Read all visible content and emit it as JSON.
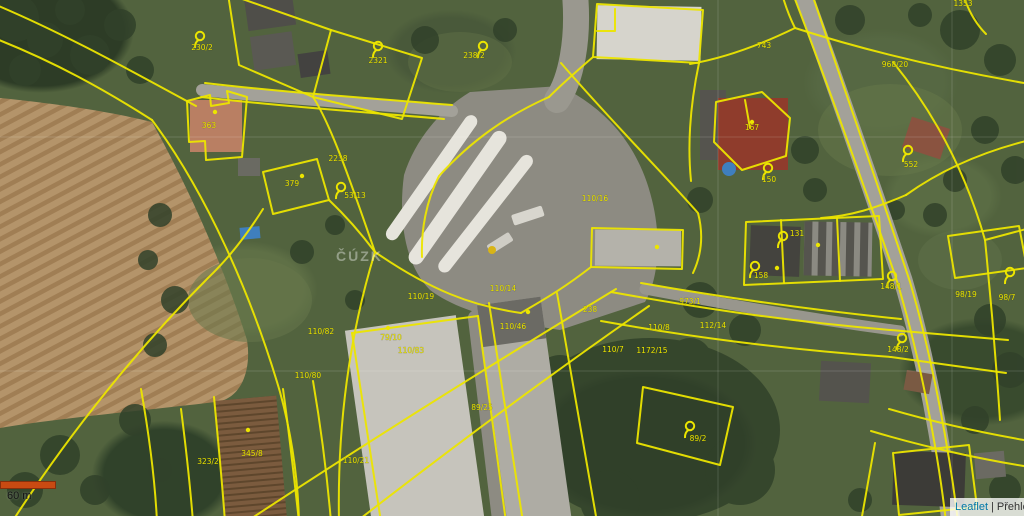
{
  "map": {
    "watermark": "ČÚZK",
    "label_color": "#e9e300",
    "line_color": "#ece500",
    "highlighted_parcels": [
      {
        "name": "orange-parcel",
        "number": "363",
        "fill": "#e06a28",
        "stroke": "#f0c800"
      },
      {
        "name": "purple-parcel",
        "number": "379",
        "fill": "#7b2fa6",
        "stroke": "#ece500"
      },
      {
        "name": "red-parcel",
        "number": "167",
        "fill": "#cc2f1e",
        "stroke": "#f0a800"
      }
    ],
    "parcel_labels": [
      {
        "text": "230/2",
        "x": 202,
        "y": 50
      },
      {
        "text": "2321",
        "x": 378,
        "y": 63
      },
      {
        "text": "238/2",
        "x": 474,
        "y": 58
      },
      {
        "text": "363",
        "x": 209,
        "y": 128
      },
      {
        "text": "379",
        "x": 292,
        "y": 186
      },
      {
        "text": "2238",
        "x": 338,
        "y": 161
      },
      {
        "text": "53/13",
        "x": 355,
        "y": 198
      },
      {
        "text": "743",
        "x": 764,
        "y": 48
      },
      {
        "text": "968/20",
        "x": 895,
        "y": 67
      },
      {
        "text": "1353",
        "x": 963,
        "y": 6
      },
      {
        "text": "167",
        "x": 752,
        "y": 130
      },
      {
        "text": "150",
        "x": 769,
        "y": 182
      },
      {
        "text": "552",
        "x": 911,
        "y": 167
      },
      {
        "text": "110/16",
        "x": 595,
        "y": 201
      },
      {
        "text": "110/19",
        "x": 421,
        "y": 299
      },
      {
        "text": "110/82",
        "x": 321,
        "y": 334
      },
      {
        "text": "79/10",
        "x": 391,
        "y": 340
      },
      {
        "text": "110/83",
        "x": 411,
        "y": 353
      },
      {
        "text": "110/80",
        "x": 308,
        "y": 378
      },
      {
        "text": "110/14",
        "x": 503,
        "y": 291
      },
      {
        "text": "110/46",
        "x": 513,
        "y": 329
      },
      {
        "text": "238",
        "x": 590,
        "y": 312
      },
      {
        "text": "110/7",
        "x": 613,
        "y": 352
      },
      {
        "text": "110/8",
        "x": 659,
        "y": 330
      },
      {
        "text": "112/14",
        "x": 713,
        "y": 328
      },
      {
        "text": "1172/15",
        "x": 652,
        "y": 353
      },
      {
        "text": "973/1",
        "x": 690,
        "y": 304
      },
      {
        "text": "148/1",
        "x": 891,
        "y": 289
      },
      {
        "text": "98/19",
        "x": 966,
        "y": 297
      },
      {
        "text": "148/2",
        "x": 898,
        "y": 352
      },
      {
        "text": "98/7",
        "x": 1007,
        "y": 300
      },
      {
        "text": "131",
        "x": 797,
        "y": 236
      },
      {
        "text": "158",
        "x": 761,
        "y": 278
      },
      {
        "text": "323/2",
        "x": 208,
        "y": 464
      },
      {
        "text": "345/8",
        "x": 252,
        "y": 456
      },
      {
        "text": "110/21",
        "x": 356,
        "y": 463
      },
      {
        "text": "89/25",
        "x": 482,
        "y": 410
      },
      {
        "text": "89/2",
        "x": 698,
        "y": 441
      }
    ],
    "pointer_markers": [
      {
        "x": 200,
        "y": 36
      },
      {
        "x": 378,
        "y": 46
      },
      {
        "x": 483,
        "y": 46
      },
      {
        "x": 341,
        "y": 187
      },
      {
        "x": 768,
        "y": 168
      },
      {
        "x": 783,
        "y": 236
      },
      {
        "x": 908,
        "y": 150
      },
      {
        "x": 902,
        "y": 338
      },
      {
        "x": 690,
        "y": 426
      },
      {
        "x": 755,
        "y": 266
      },
      {
        "x": 892,
        "y": 276
      },
      {
        "x": 1010,
        "y": 272
      }
    ],
    "point_dots": [
      {
        "x": 657,
        "y": 247
      },
      {
        "x": 777,
        "y": 268
      },
      {
        "x": 818,
        "y": 245
      },
      {
        "x": 388,
        "y": 328
      },
      {
        "x": 528,
        "y": 312
      },
      {
        "x": 302,
        "y": 176
      },
      {
        "x": 215,
        "y": 112
      },
      {
        "x": 752,
        "y": 122
      },
      {
        "x": 248,
        "y": 430
      }
    ]
  },
  "controls": {
    "scale_bar": {
      "label": "60 m",
      "bar_color": "#c94a12"
    },
    "attribution": {
      "leaflet_link": "Leaflet",
      "separator": "|",
      "layer_link": "Přehle"
    }
  }
}
